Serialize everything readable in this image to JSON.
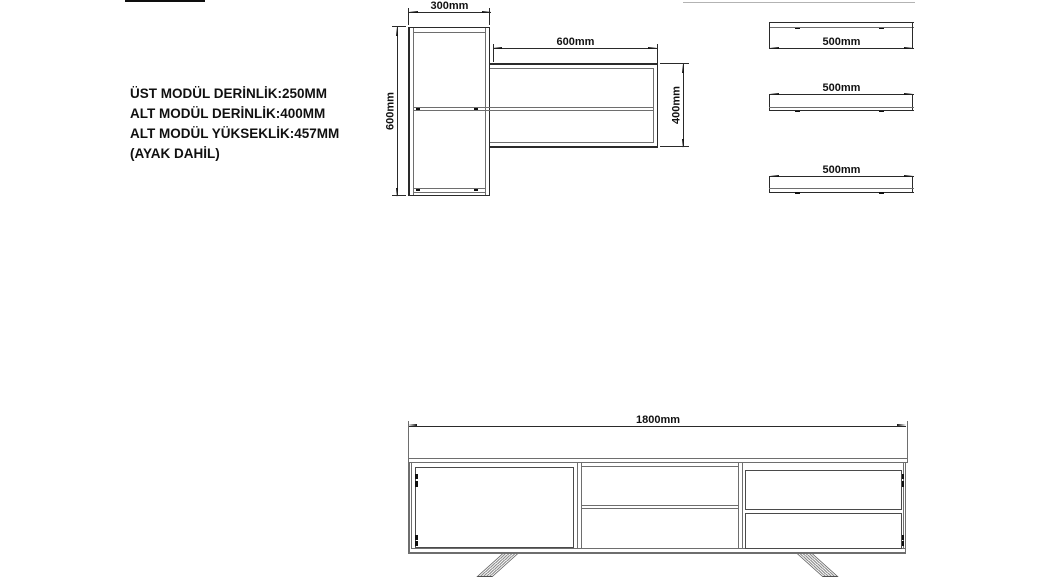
{
  "title_notes": [
    "ÜST MODÜL DERİNLİK:250MM",
    "ALT MODÜL DERİNLİK:400MM",
    "ALT MODÜL YÜKSEKLİK:457MM",
    "(AYAK DAHİL)"
  ],
  "dimensions": {
    "upper_cabinet_width": "300mm",
    "upper_cabinet_height": "600mm",
    "upper_shelf_unit_width": "600mm",
    "upper_shelf_unit_height": "400mm",
    "wall_shelf_1": "500mm",
    "wall_shelf_2": "500mm",
    "wall_shelf_3": "500mm",
    "tv_stand_width": "1800mm"
  },
  "colors": {
    "background": "#ffffff",
    "line_dark": "#2a2a2a",
    "line_gray": "#6e6e6e",
    "text": "#111111"
  }
}
